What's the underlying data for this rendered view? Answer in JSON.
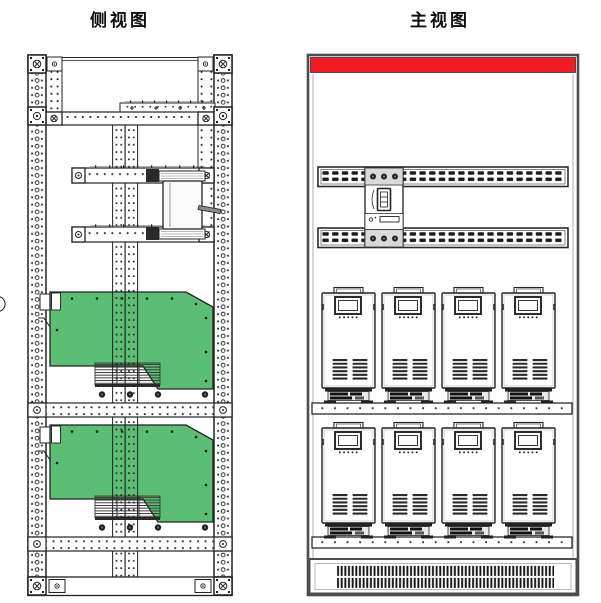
{
  "side_view": {
    "title": "侧视图",
    "power_module_count": 2,
    "shelf_count": 2,
    "breaker_rail_count": 2,
    "rack": {
      "outer_rails": 2,
      "inner_rails": 2,
      "middle_rails": 2
    },
    "breaker_present": true
  },
  "front_view": {
    "title": "主视图",
    "busbar_rows": 2,
    "module_rows": 2,
    "modules_per_row": 4,
    "shelf_count": 2,
    "grille_bar_rows": 2,
    "breaker_present": true
  },
  "colors": {
    "module_green": "#5CBE74",
    "accent_red": "#EE1D23",
    "line_dark": "#222222",
    "cabinet_gray": "#4d4d4d"
  }
}
